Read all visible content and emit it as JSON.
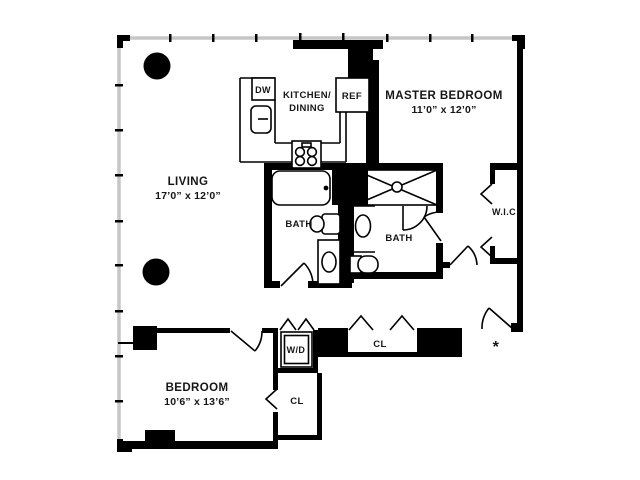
{
  "plan": {
    "title": "apartment-floor-plan",
    "rooms": {
      "living": {
        "label": "LIVING",
        "dims": "17’0” x 12’0”"
      },
      "kitchen": {
        "label_line1": "KITCHEN/",
        "label_line2": "DINING"
      },
      "master_bedroom": {
        "label": "MASTER BEDROOM",
        "dims": "11’0” x 12’0”"
      },
      "bath_left": {
        "label": "BATH"
      },
      "bath_right": {
        "label": "BATH"
      },
      "walk_in_closet": {
        "label": "W.I.C"
      },
      "bedroom": {
        "label": "BEDROOM",
        "dims": "10’6” x 13’6”"
      },
      "hall_closet": {
        "label": "CL"
      },
      "bedroom_closet": {
        "label": "CL"
      }
    },
    "fixtures": {
      "dishwasher": "DW",
      "refrigerator": "REF",
      "washer_dryer": "W/D"
    },
    "entry_marker": "*",
    "colors": {
      "wall": "#000000",
      "window_wall": "#c6c6c6",
      "background": "#ffffff",
      "text": "#161616"
    }
  }
}
